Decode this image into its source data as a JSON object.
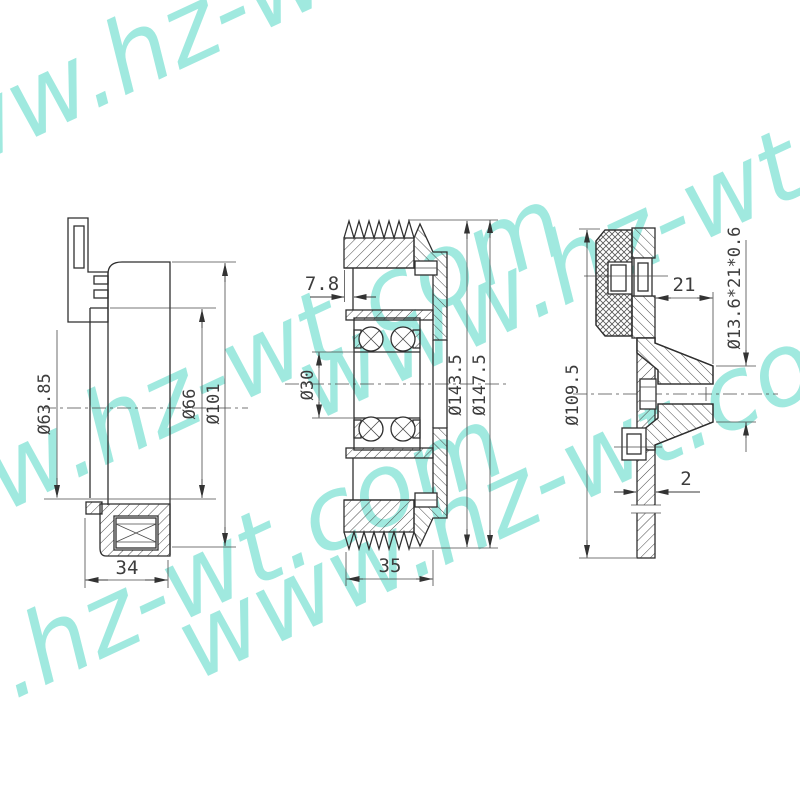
{
  "watermark": {
    "text": "www.hz-wt.com",
    "color": "#a0e9df"
  },
  "colors": {
    "background": "#ffffff",
    "line": "#2f2f2f",
    "dimension_text": "#3d3d3d"
  },
  "views": {
    "coil_housing": {
      "dimensions": {
        "inner_diameter": "Ø63.85",
        "bore_diameter": "Ø66",
        "outer_diameter": "Ø101",
        "width": "34"
      }
    },
    "pulley": {
      "dimensions": {
        "pilot_depth": "7.8",
        "bore_diameter": "Ø30",
        "groove_root_diameter": "Ø143.5",
        "outer_diameter": "Ø147.5",
        "width": "35"
      }
    },
    "hub_plate": {
      "dimensions": {
        "outer_diameter": "Ø109.5",
        "hub_length": "21",
        "boss_spec": "Ø13.6*21*0.6",
        "plate_thickness": "2"
      }
    }
  }
}
